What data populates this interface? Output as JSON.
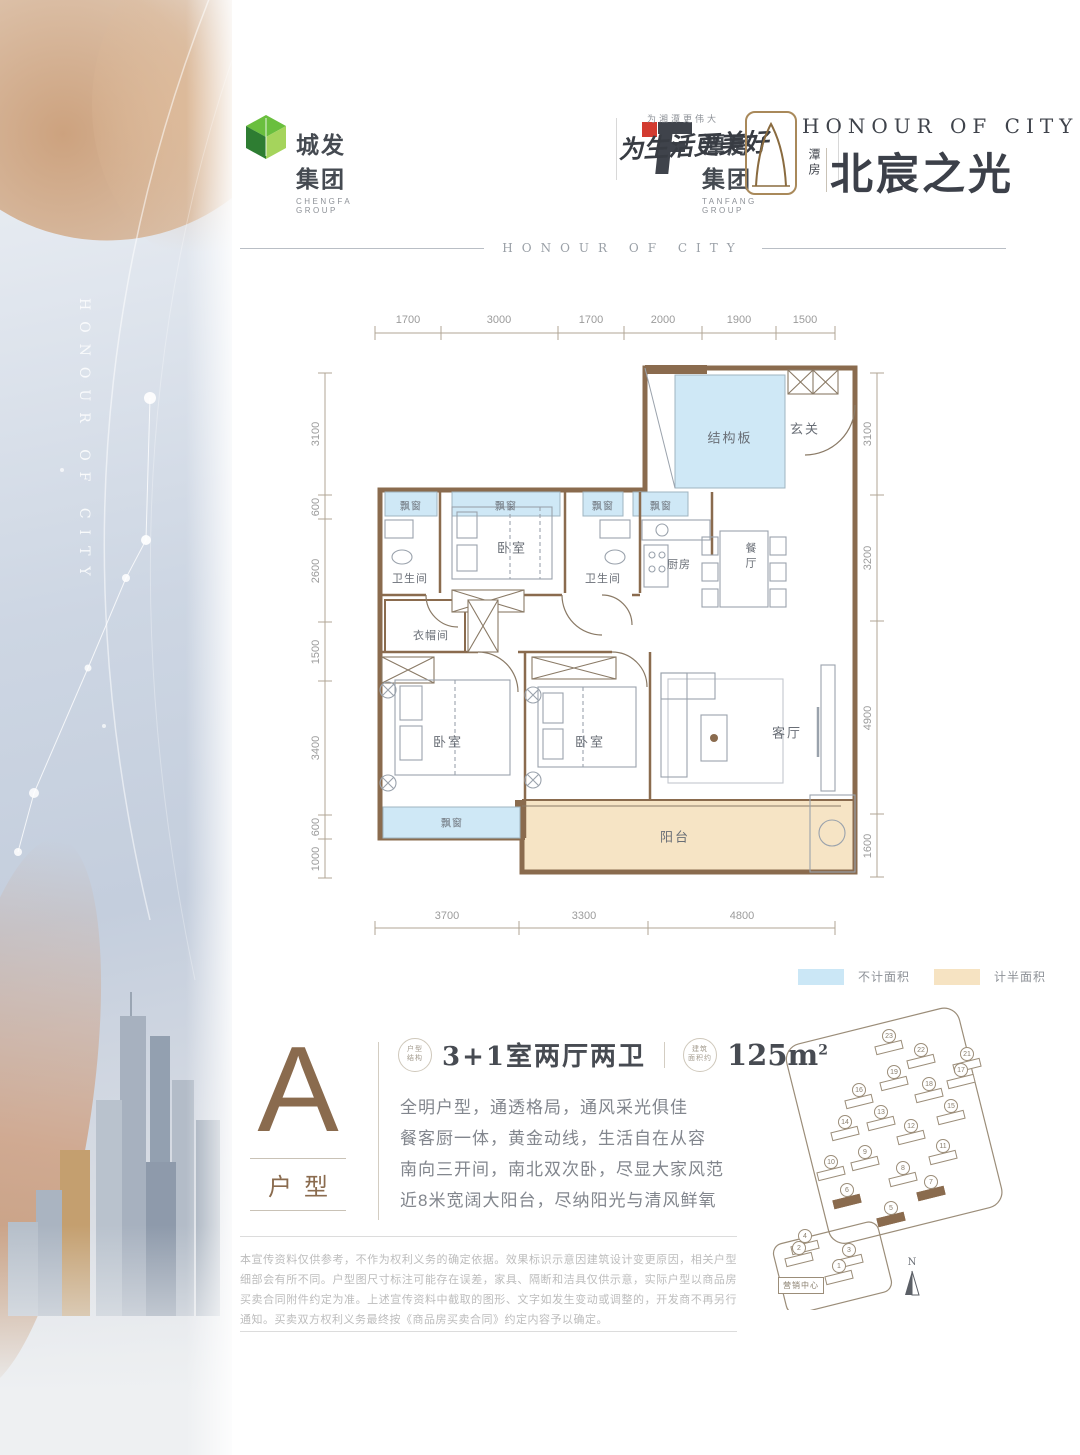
{
  "sidebar": {
    "vertical_text": "HONOUR OF CITY"
  },
  "header": {
    "logo1": {
      "name": "城发集团",
      "sub": "CHENGFA GROUP"
    },
    "logo2": {
      "name": "潭房集团",
      "sub": "TANFANG GROUP"
    },
    "slogan_small": "为湘潭更伟大",
    "slogan": "为生活更美好",
    "brand": {
      "en": "HONOUR OF CITY",
      "cn_small": "潭房",
      "cn": "北宸之光"
    }
  },
  "section_divider": "HONOUR OF CITY",
  "plan": {
    "dims_top": [
      "1700",
      "3000",
      "1700",
      "2000",
      "1900",
      "1500"
    ],
    "dims_left": [
      "3100",
      "600",
      "2600",
      "1500",
      "3400",
      "600",
      "1000"
    ],
    "dims_right": [
      "3100",
      "3200",
      "4900",
      "1600"
    ],
    "dims_bottom": [
      "3700",
      "3300",
      "4800"
    ],
    "rooms": {
      "structure": "结构板",
      "entry": "玄关",
      "bay": "飘窗",
      "bedroom": "卧室",
      "bath": "卫生间",
      "kitchen": "厨房",
      "dining": "餐厅",
      "cloak": "衣帽间",
      "living": "客厅",
      "balcony": "阳台"
    }
  },
  "legend": {
    "no_area": "不计面积",
    "no_area_color": "#cbe7f6",
    "half_area": "计半面积",
    "half_area_color": "#f6e3c2"
  },
  "unit": {
    "letter": "A",
    "type_label": "户型",
    "badge1_l1": "户型",
    "badge1_l2": "结构",
    "spec": "3+1室两厅两卫",
    "badge2_l1": "建筑",
    "badge2_l2": "面积约",
    "area": "125m",
    "area_sup": "2",
    "desc": [
      "全明户型，通透格局，通风采光俱佳",
      "餐客厨一体，黄金动线，生活自在从容",
      "南向三开间，南北双次卧，尽显大家风范",
      "近8米宽阔大阳台，尽纳阳光与清风鲜氧"
    ]
  },
  "siteplan": {
    "marketing": "营销中心",
    "north": "N",
    "buildings": [
      {
        "n": "23",
        "x": 118,
        "y": 38
      },
      {
        "n": "22",
        "x": 150,
        "y": 52
      },
      {
        "n": "21",
        "x": 196,
        "y": 56
      },
      {
        "n": "19",
        "x": 123,
        "y": 74
      },
      {
        "n": "18",
        "x": 158,
        "y": 86
      },
      {
        "n": "17",
        "x": 190,
        "y": 72
      },
      {
        "n": "16",
        "x": 88,
        "y": 92
      },
      {
        "n": "15",
        "x": 180,
        "y": 108
      },
      {
        "n": "14",
        "x": 74,
        "y": 124
      },
      {
        "n": "13",
        "x": 110,
        "y": 114
      },
      {
        "n": "12",
        "x": 140,
        "y": 128
      },
      {
        "n": "11",
        "x": 172,
        "y": 148
      },
      {
        "n": "10",
        "x": 60,
        "y": 164
      },
      {
        "n": "9",
        "x": 94,
        "y": 154
      },
      {
        "n": "8",
        "x": 132,
        "y": 170
      },
      {
        "n": "7",
        "x": 160,
        "y": 184,
        "hl": true
      },
      {
        "n": "6",
        "x": 76,
        "y": 192,
        "hl": true
      },
      {
        "n": "5",
        "x": 120,
        "y": 210,
        "hl": true
      },
      {
        "n": "4",
        "x": 34,
        "y": 238
      },
      {
        "n": "3",
        "x": 78,
        "y": 252
      },
      {
        "n": "2",
        "x": 28,
        "y": 250
      },
      {
        "n": "1",
        "x": 68,
        "y": 268
      }
    ]
  },
  "disclaimer": "本宣传资料仅供参考，不作为权利义务的确定依据。效果标识示意因建筑设计变更原因，相关户型细部会有所不同。户型图尺寸标注可能存在误差，家具、隔断和洁具仅供示意，实际户型以商品房买卖合同附件约定为准。上述宣传资料中截取的图形、文字如发生变动或调整的，开发商不再另行通知。买卖双方权利义务最终按《商品房买卖合同》约定内容予以确定。"
}
